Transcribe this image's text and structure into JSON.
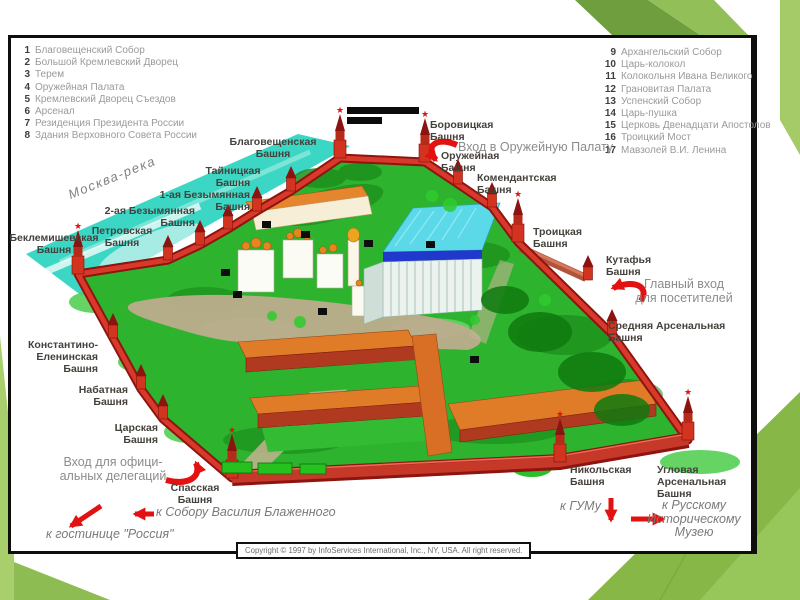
{
  "legend_left": [
    {
      "num": "1",
      "label": "Благовещенский Собор"
    },
    {
      "num": "2",
      "label": "Большой Кремлевский Дворец"
    },
    {
      "num": "3",
      "label": "Терем"
    },
    {
      "num": "4",
      "label": "Оружейная Палата"
    },
    {
      "num": "5",
      "label": "Кремлевский Дворец Съездов"
    },
    {
      "num": "6",
      "label": "Арсенал"
    },
    {
      "num": "7",
      "label": "Резиденция Президента России"
    },
    {
      "num": "8",
      "label": "Здания Верховного Совета России"
    }
  ],
  "legend_right": [
    {
      "num": "9",
      "label": "Архангельский Собор"
    },
    {
      "num": "10",
      "label": "Царь-колокол"
    },
    {
      "num": "11",
      "label": "Колокольня Ивана Великого"
    },
    {
      "num": "12",
      "label": "Грановитая Палата"
    },
    {
      "num": "13",
      "label": "Успенский Собор"
    },
    {
      "num": "14",
      "label": "Царь-пушка"
    },
    {
      "num": "15",
      "label": "Церковь Двенадцати Апостолов"
    },
    {
      "num": "16",
      "label": "Троицкий Мост"
    },
    {
      "num": "17",
      "label": "Мавзолей В.И. Ленина"
    }
  ],
  "tower_labels": [
    {
      "id": "blagoveshchenskaya",
      "text": "Благовещенская\nБашня"
    },
    {
      "id": "taynitskaya",
      "text": "Тайницкая\nБашня"
    },
    {
      "id": "bezymyannaya1",
      "text": "1-ая Безымянная\nБашня"
    },
    {
      "id": "bezymyannaya2",
      "text": "2-ая Безымянная\nБашня"
    },
    {
      "id": "petrovskaya",
      "text": "Петровская\nБашня"
    },
    {
      "id": "beklemishevskaya",
      "text": "Беклемишевская\nБашня"
    },
    {
      "id": "borovitskaya",
      "text": "Боровицкая\nБашня"
    },
    {
      "id": "oruzheynaya",
      "text": "Оружейная\nБашня"
    },
    {
      "id": "komendantskaya",
      "text": "Комендантская\nБашня"
    },
    {
      "id": "troitskaya",
      "text": "Троицкая\nБашня"
    },
    {
      "id": "kutafya",
      "text": "Кутафья\nБашня"
    },
    {
      "id": "srednyaya",
      "text": "Средняя Арсенальная\nБашня"
    },
    {
      "id": "konstantino",
      "text": "Константино-\nЕленинская\nБашня"
    },
    {
      "id": "nabatnaya",
      "text": "Набатная\nБашня"
    },
    {
      "id": "tsarskaya",
      "text": "Царская\nБашня"
    },
    {
      "id": "spasskaya",
      "text": "Спасская\nБашня"
    },
    {
      "id": "nikolskaya",
      "text": "Никольская\nБашня"
    },
    {
      "id": "uglovaya",
      "text": "Угловая\nАрсенальная\nБашня"
    }
  ],
  "entrance_labels": [
    {
      "id": "armoury_entrance",
      "text": "Вход в Оружейную Палату"
    },
    {
      "id": "main_entrance",
      "text": "Главный вход\nдля посетителей"
    },
    {
      "id": "delegation_entrance",
      "text": "Вход для офици-\nальных делегаций"
    }
  ],
  "direction_labels": [
    {
      "id": "to_st_basil",
      "text": "к Собору Василия Блаженного"
    },
    {
      "id": "to_rossiya",
      "text": "к гостинице \"Россия\""
    },
    {
      "id": "to_gum",
      "text": "к ГУМу"
    },
    {
      "id": "to_history_museum",
      "text": "к Русскому\nИсторическому\nМузею"
    }
  ],
  "river_label": "Москва-река",
  "copyright": "Copyright © 1997 by InfoServices International, Inc., NY, USA. All right reserved.",
  "colors": {
    "accent_green_dark": "#6f9e3e",
    "accent_green_light": "#92bf57",
    "accent_green_pale": "#a9cf6d",
    "arrow_red": "#e21212",
    "wall_red": "#d23420",
    "river_teal": "#3bd6c4",
    "grounds_green": "#2eb32e"
  }
}
